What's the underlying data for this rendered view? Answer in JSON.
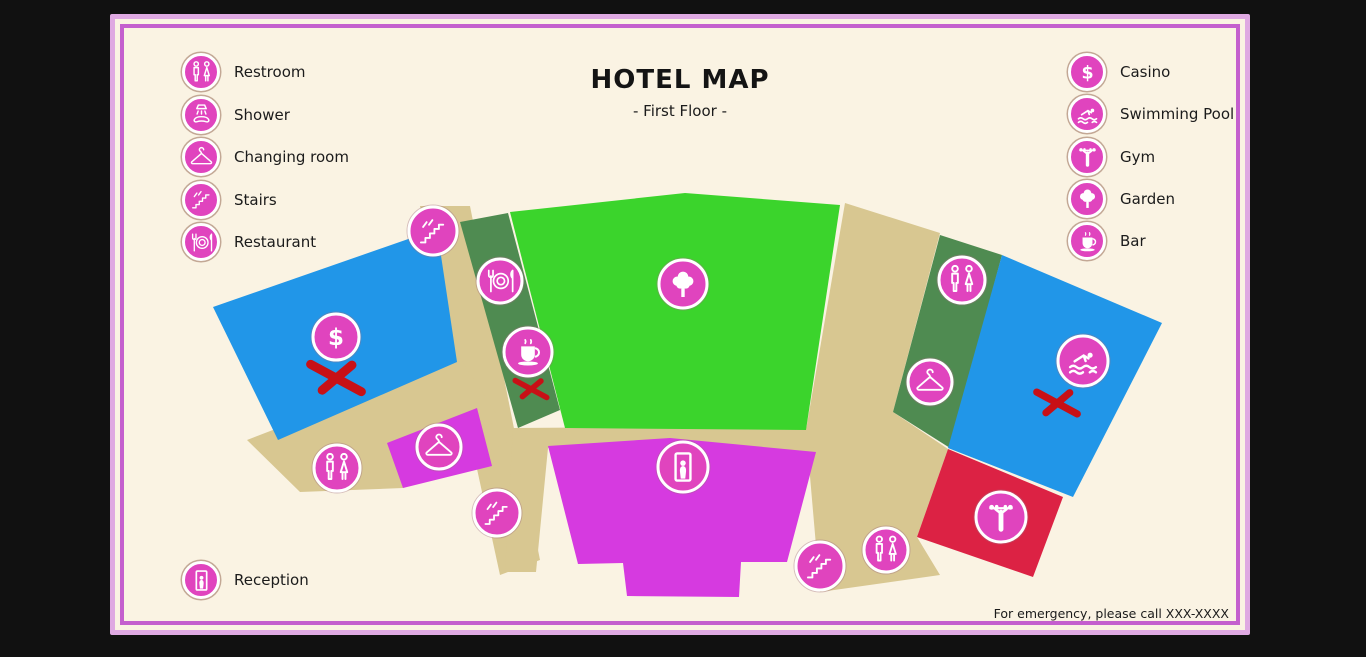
{
  "title": "HOTEL MAP",
  "subtitle": "- First Floor -",
  "legend_left": [
    {
      "icon": "restroom",
      "label": "Restroom"
    },
    {
      "icon": "shower",
      "label": "Shower"
    },
    {
      "icon": "changing",
      "label": "Changing room"
    },
    {
      "icon": "stairs",
      "label": "Stairs"
    },
    {
      "icon": "restaurant",
      "label": "Restaurant"
    }
  ],
  "legend_right": [
    {
      "icon": "casino",
      "label": "Casino"
    },
    {
      "icon": "pool",
      "label": "Swimming Pool"
    },
    {
      "icon": "gym",
      "label": "Gym"
    },
    {
      "icon": "garden",
      "label": "Garden"
    },
    {
      "icon": "bar",
      "label": "Bar"
    }
  ],
  "legend_bottom": [
    {
      "icon": "reception",
      "label": "Reception"
    }
  ],
  "footer": "For emergency, please call XXX-XXXX",
  "colors": {
    "background": "#111111",
    "card": "#faf3e3",
    "border_outer": "#dfa9e2",
    "border_inner": "#c45fce",
    "walkway": "#d8c791",
    "marker_pink": "#e044be",
    "cross_red": "#c81016",
    "room_blue": "#2196e8",
    "room_green": "#3bd42c",
    "room_darkgreen": "#4f8b51",
    "room_magenta": "#d63ae0",
    "room_red": "#dc2244"
  },
  "map": {
    "walkways": [
      {
        "name": "walkway-left-band",
        "points": [
          [
            310,
            192
          ],
          [
            360,
            192
          ],
          [
            430,
            546
          ],
          [
            390,
            561
          ]
        ]
      },
      {
        "name": "walkway-lower-left",
        "points": [
          [
            137,
            426
          ],
          [
            350,
            344
          ],
          [
            403,
            426
          ],
          [
            293,
            474
          ],
          [
            190,
            478
          ]
        ]
      },
      {
        "name": "walkway-right-band",
        "points": [
          [
            735,
            189
          ],
          [
            830,
            219
          ],
          [
            783,
            398
          ],
          [
            838,
            435
          ],
          [
            807,
            523
          ],
          [
            830,
            561
          ],
          [
            710,
            578
          ],
          [
            696,
            416
          ]
        ]
      },
      {
        "name": "walkway-mid-band",
        "points": [
          [
            403,
            414
          ],
          [
            696,
            412
          ],
          [
            706,
            441
          ],
          [
            438,
            434
          ],
          [
            426,
            558
          ],
          [
            395,
            558
          ]
        ]
      }
    ],
    "regions": [
      {
        "name": "casino-room",
        "color": "room_blue",
        "points": [
          [
            103,
            293
          ],
          [
            327,
            215
          ],
          [
            347,
            348
          ],
          [
            168,
            426
          ]
        ]
      },
      {
        "name": "restaurant-strip",
        "color": "room_darkgreen",
        "points": [
          [
            350,
            208
          ],
          [
            398,
            199
          ],
          [
            450,
            396
          ],
          [
            408,
            414
          ]
        ]
      },
      {
        "name": "garden-area",
        "color": "room_green",
        "points": [
          [
            400,
            198
          ],
          [
            575,
            179
          ],
          [
            730,
            191
          ],
          [
            696,
            416
          ],
          [
            455,
            414
          ]
        ]
      },
      {
        "name": "restroom-strip",
        "color": "room_darkgreen",
        "points": [
          [
            830,
            221
          ],
          [
            892,
            241
          ],
          [
            840,
            434
          ],
          [
            783,
            398
          ]
        ]
      },
      {
        "name": "pool-room",
        "color": "room_blue",
        "points": [
          [
            892,
            241
          ],
          [
            1052,
            309
          ],
          [
            963,
            483
          ],
          [
            838,
            434
          ]
        ]
      },
      {
        "name": "gym-room",
        "color": "room_red",
        "points": [
          [
            838,
            435
          ],
          [
            953,
            483
          ],
          [
            923,
            563
          ],
          [
            807,
            523
          ]
        ]
      },
      {
        "name": "reception-hall",
        "color": "room_magenta",
        "points": [
          [
            438,
            432
          ],
          [
            560,
            424
          ],
          [
            706,
            438
          ],
          [
            677,
            548
          ],
          [
            631,
            548
          ],
          [
            629,
            583
          ],
          [
            517,
            582
          ],
          [
            513,
            549
          ],
          [
            468,
            550
          ]
        ]
      },
      {
        "name": "changing-room",
        "color": "room_magenta",
        "points": [
          [
            277,
            429
          ],
          [
            367,
            394
          ],
          [
            382,
            452
          ],
          [
            293,
            474
          ]
        ]
      }
    ],
    "markers": [
      {
        "icon": "stairs",
        "x": 323,
        "y": 217,
        "r": 24
      },
      {
        "icon": "restaurant",
        "x": 390,
        "y": 267,
        "r": 22
      },
      {
        "icon": "bar",
        "x": 418,
        "y": 338,
        "r": 24
      },
      {
        "icon": "casino",
        "x": 226,
        "y": 323,
        "r": 23
      },
      {
        "icon": "garden",
        "x": 573,
        "y": 270,
        "r": 24
      },
      {
        "icon": "reception",
        "x": 573,
        "y": 453,
        "r": 25
      },
      {
        "icon": "restroom",
        "x": 227,
        "y": 454,
        "r": 23
      },
      {
        "icon": "changing",
        "x": 329,
        "y": 433,
        "r": 22
      },
      {
        "icon": "stairs",
        "x": 387,
        "y": 499,
        "r": 23
      },
      {
        "icon": "restroom",
        "x": 852,
        "y": 266,
        "r": 23
      },
      {
        "icon": "changing",
        "x": 820,
        "y": 368,
        "r": 22
      },
      {
        "icon": "pool",
        "x": 973,
        "y": 347,
        "r": 25
      },
      {
        "icon": "gym",
        "x": 891,
        "y": 503,
        "r": 25
      },
      {
        "icon": "stairs",
        "x": 710,
        "y": 552,
        "r": 24
      },
      {
        "icon": "restroom",
        "x": 776,
        "y": 536,
        "r": 22
      }
    ],
    "crosses": [
      {
        "x": 226,
        "y": 364,
        "scale": 1.0
      },
      {
        "x": 421,
        "y": 375,
        "scale": 0.62
      },
      {
        "x": 947,
        "y": 389,
        "scale": 0.8
      }
    ]
  }
}
